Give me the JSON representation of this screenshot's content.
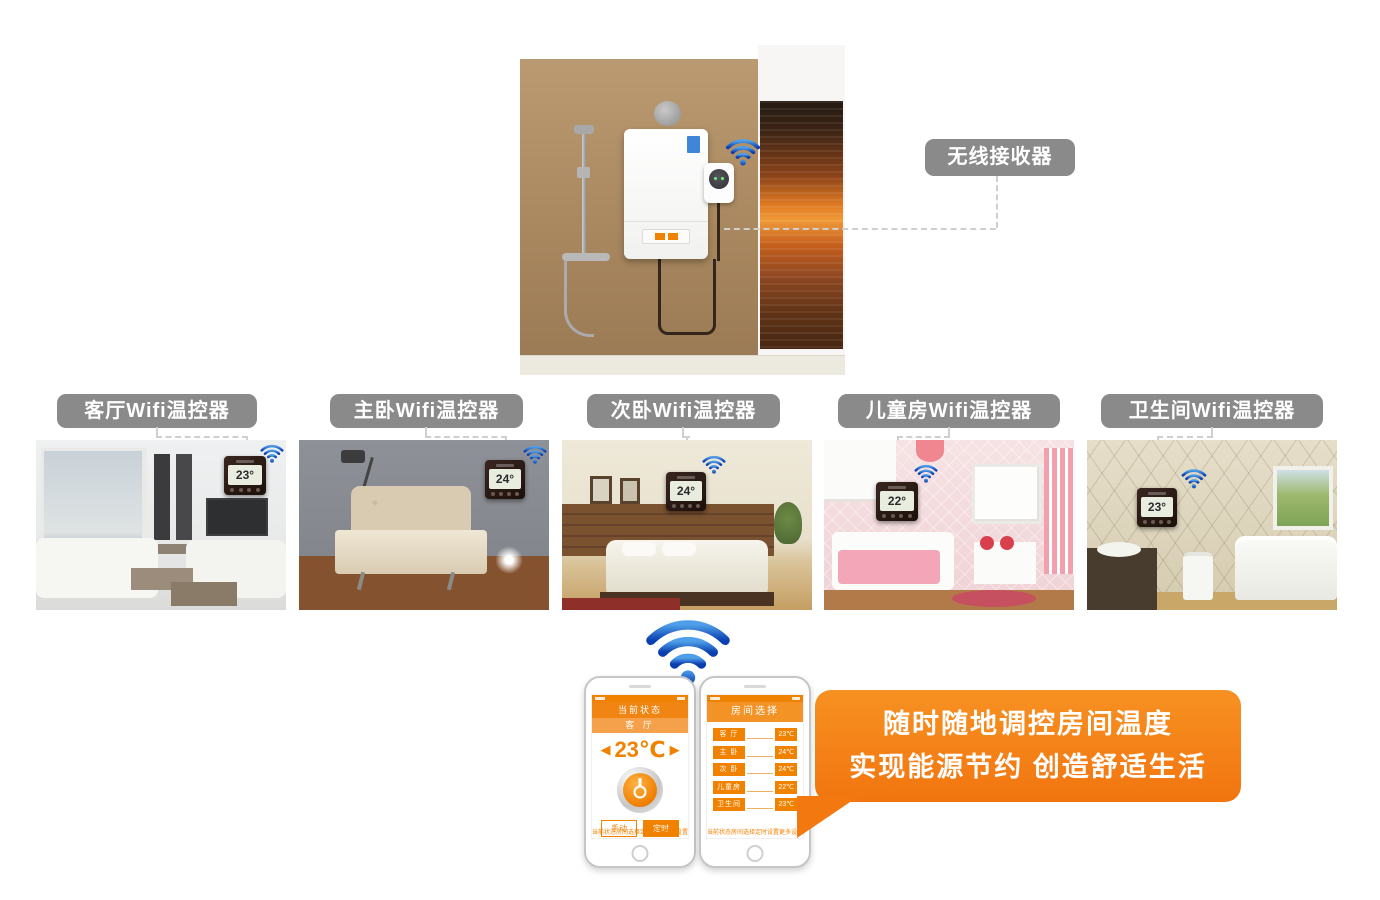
{
  "receiver": {
    "label": "无线接收器"
  },
  "rooms": [
    {
      "label": "客厅Wifi温控器",
      "temp": "23°"
    },
    {
      "label": "主卧Wifi温控器",
      "temp": "24°"
    },
    {
      "label": "次卧Wifi温控器",
      "temp": "24°"
    },
    {
      "label": "儿童房Wifi温控器",
      "temp": "22°"
    },
    {
      "label": "卫生间Wifi温控器",
      "temp": "23°"
    }
  ],
  "phone_left": {
    "status_title": "当前状态",
    "room_name": "客 厅",
    "left_arrow": "◀",
    "temperature": "23℃",
    "right_arrow": "▶",
    "manual_button": "手动",
    "timer_button": "定时"
  },
  "phone_right": {
    "title": "房间选择",
    "rows": [
      {
        "name": "客 厅",
        "temp": "23℃"
      },
      {
        "name": "主 卧",
        "temp": "24℃"
      },
      {
        "name": "次 卧",
        "temp": "24℃"
      },
      {
        "name": "儿童房",
        "temp": "22℃"
      },
      {
        "name": "卫生间",
        "temp": "23℃"
      }
    ]
  },
  "phone_nav": [
    "当前状态",
    "房间选择",
    "定时设置",
    "更多设置"
  ],
  "bubble": {
    "line1": "随时随地调控房间温度",
    "line2": "实现能源节约 创造舒适生活"
  },
  "colors": {
    "accent_orange": "#f08200",
    "tag_gray": "#8a8a8a",
    "wifi_blue": "#1e62d0"
  }
}
